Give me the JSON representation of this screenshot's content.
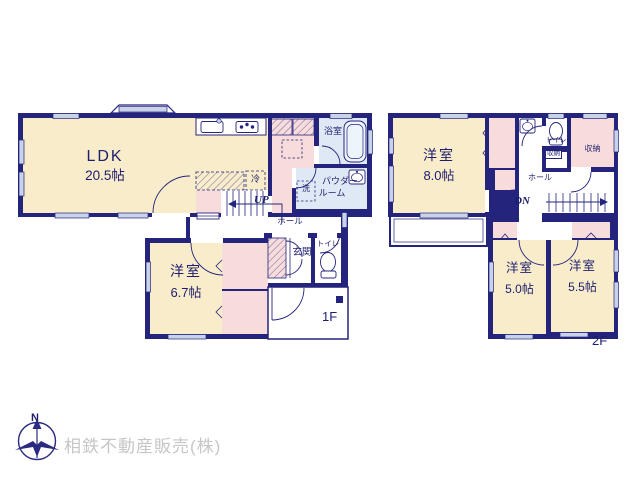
{
  "f1": {
    "label": "1F",
    "ldk_name": "LDK",
    "ldk_size": "20.5帖",
    "room_name": "洋室",
    "room_size": "6.7帖",
    "bath": "浴室",
    "powder_line1": "パウダー",
    "powder_line2": "ルーム",
    "washer": "洗",
    "fridge": "冷",
    "up": "UP",
    "hall": "ホール",
    "entrance": "玄関",
    "toilet": "トイレ"
  },
  "f2": {
    "label": "2F",
    "room8_name": "洋室",
    "room8_size": "8.0帖",
    "room5_name": "洋室",
    "room5_size": "5.0帖",
    "room55_name": "洋室",
    "room55_size": "5.5帖",
    "toilet": "トイレ",
    "storage_small": "収納",
    "storage_large": "収納",
    "hall": "ホール",
    "dn": "DN"
  },
  "footer": {
    "compass_north": "N",
    "company": "相鉄不動産販売(株)"
  },
  "palette": {
    "wall": "#24247c",
    "room_fill": "#f8ecca",
    "closet_fill": "#f8dbdb",
    "wet_fill": "#dfe9f6",
    "window_fill": "#c8d2e9",
    "label_text": "#1e1e6e",
    "company_text": "#c6c6c6"
  }
}
